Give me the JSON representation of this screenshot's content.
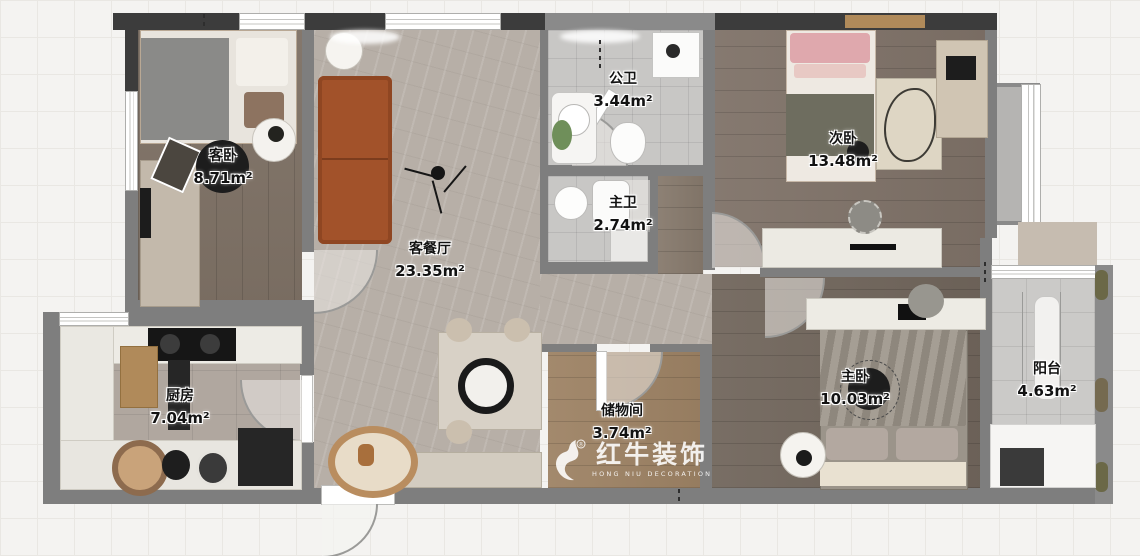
{
  "meta": {
    "title": "apartment-floor-plan",
    "canvas": {
      "width": 1140,
      "height": 556
    }
  },
  "watermark": {
    "brand": "红牛装饰",
    "subtitle": "HONG NIU DECORATION",
    "registered": "®"
  },
  "rooms": [
    {
      "name": "客卧",
      "area": "8.71m²"
    },
    {
      "name": "客餐厅",
      "area": "23.35m²"
    },
    {
      "name": "公卫",
      "area": "3.44m²"
    },
    {
      "name": "主卫",
      "area": "2.74m²"
    },
    {
      "name": "次卧",
      "area": "13.48m²"
    },
    {
      "name": "厨房",
      "area": "7.04m²"
    },
    {
      "name": "储物间",
      "area": "3.74m²"
    },
    {
      "name": "主卧",
      "area": "10.03m²"
    },
    {
      "name": "阳台",
      "area": "4.63m²"
    }
  ],
  "colors": {
    "wall": "#7e7e7e",
    "wall_dark": "#3c3c3c",
    "living_floor": "#b7afa7",
    "bedroom_wood": "#7f7268",
    "master_wood": "#71665c",
    "storage_wood": "#9e8365",
    "bath_tile": "#c8c7c5",
    "balcony_tile": "#cbcac8",
    "sofa_accent": "#a2522a"
  }
}
